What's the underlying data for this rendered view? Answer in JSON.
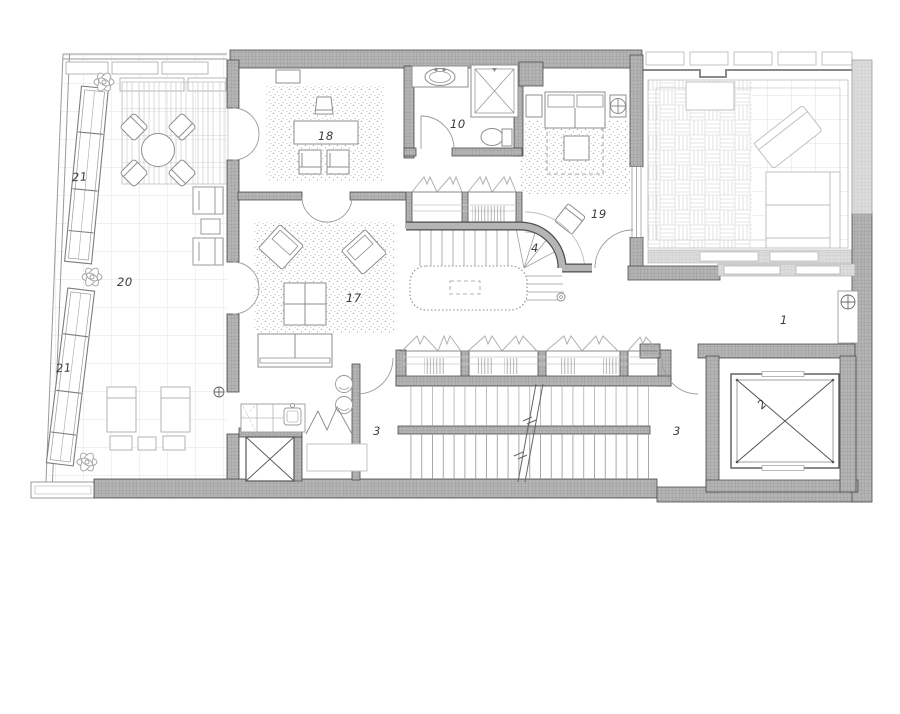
{
  "drawing": {
    "kind": "architectural floor plan",
    "labels": {
      "corridor": "1",
      "elevator": "2",
      "landing_left": "3",
      "landing_right": "3",
      "curved_stair": "4",
      "bathroom": "10",
      "living_room": "17",
      "study": "18",
      "bedroom": "19",
      "terrace": "20",
      "planter_upper": "21",
      "planter_lower": "21"
    },
    "colors": {
      "background": "#ffffff",
      "wall_fill": "#b4b4b4",
      "wall_fill_light": "#dedede",
      "line_dark": "#4c4c4c",
      "line_mid": "#8d8d8d",
      "line_light": "#c6c6c6"
    }
  }
}
